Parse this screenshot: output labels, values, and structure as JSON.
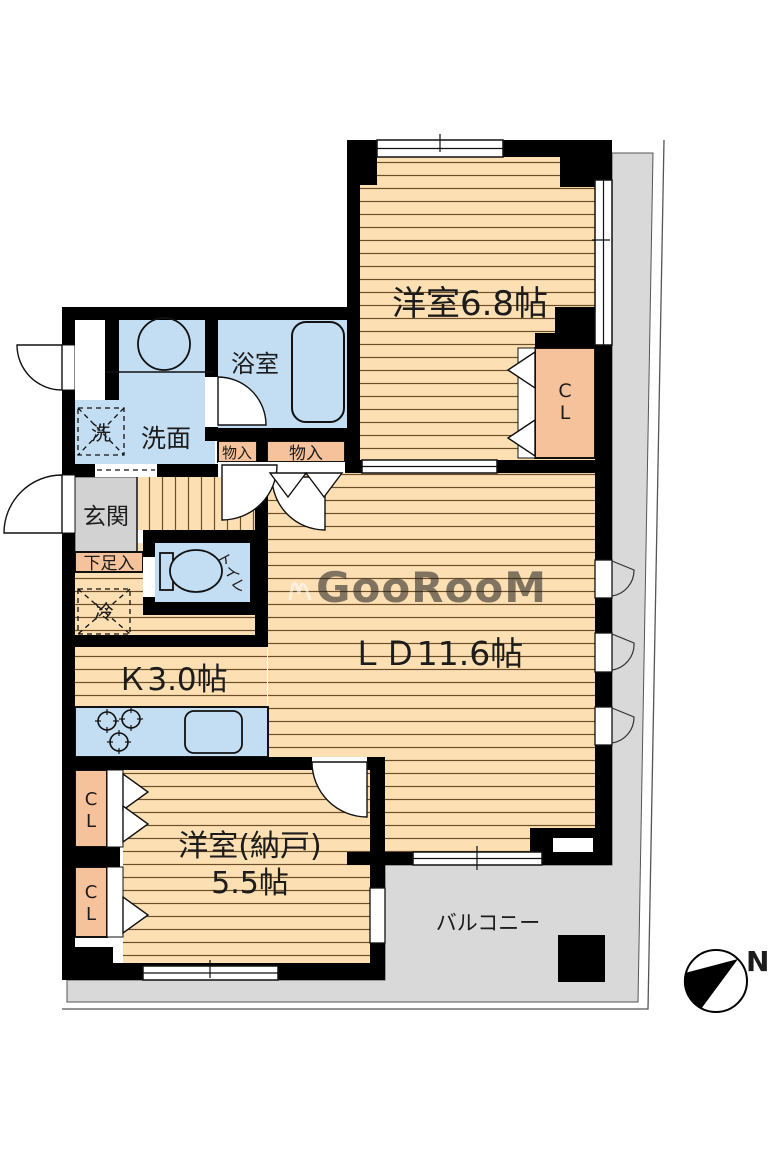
{
  "page": {
    "type": "floor-plan"
  },
  "colors": {
    "floor": "#fcdfb2",
    "floor_stripe": "#6b4f2a",
    "water_blue": "#c3ddf2",
    "closet_salmon": "#f6c29c",
    "exterior_gray": "#d9d9d9",
    "entrance_gray": "#d2d2d2",
    "wall": "#000000"
  },
  "labels": {
    "western_room": "洋室6.8帖",
    "living_dining": "ＬＤ11.6帖",
    "kitchen": "Ｋ3.0帖",
    "storage_room_line1": "洋室(納戸)",
    "storage_room_line2": "5.5帖",
    "bathroom": "浴室",
    "washroom": "洗面",
    "washer": "洗",
    "fridge": "冷",
    "toilet": "トイレ",
    "entrance": "玄関",
    "shoe_cabinet": "下足入",
    "storage1": "物入",
    "storage2": "物入",
    "closet_top": "C",
    "closet_bottom": "L",
    "balcony": "バルコニー",
    "compass_north": "N",
    "watermark": "GooRooM"
  }
}
